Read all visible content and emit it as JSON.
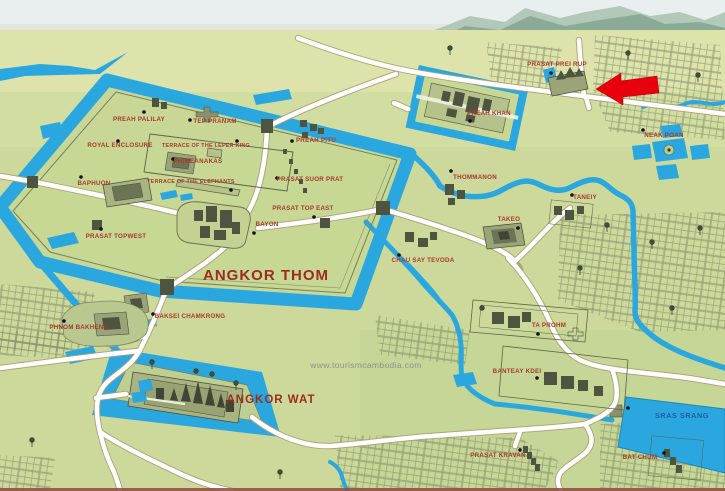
{
  "map": {
    "watermark": "www.tourismcambodia.com",
    "colors": {
      "water": "#2ba7e0",
      "land": "#ccd99b",
      "road": "#ffffff",
      "label_red": "#a8392c",
      "title_red": "#9c2c21",
      "water_label_blue": "#1d5e9e",
      "watermark_gray": "#8f9090",
      "arrow_red": "#e8000d",
      "sketch": "#4d5540"
    },
    "arrow": {
      "color": "#e8000d",
      "direction": "left",
      "points_at": "PRASAT PREI RUP"
    },
    "labels": [
      {
        "id": "prasat-prei-rup",
        "text": "PRASAT PREI RUP",
        "x": 557,
        "y": 66,
        "kind": "label",
        "dot": [
          551,
          73
        ]
      },
      {
        "id": "preah-khan",
        "text": "PREAH KHAN",
        "x": 489,
        "y": 115,
        "kind": "label",
        "dot": [
          470,
          121
        ]
      },
      {
        "id": "neak-poan",
        "text": "NEAK POAN",
        "x": 664,
        "y": 137,
        "kind": "label",
        "dot": [
          643,
          130
        ]
      },
      {
        "id": "preah-palilay",
        "text": "PREAH PALILAY",
        "x": 139,
        "y": 121,
        "kind": "label",
        "dot": [
          144,
          112
        ]
      },
      {
        "id": "tep-pranam",
        "text": "TEP PRANAM",
        "x": 215,
        "y": 123,
        "kind": "label",
        "dot": [
          190,
          120
        ]
      },
      {
        "id": "royal-enclosure",
        "text": "ROYAL ENCLOSURE",
        "x": 120,
        "y": 147,
        "kind": "label",
        "dot": [
          118,
          141
        ]
      },
      {
        "id": "terrace-of-the-leper-king",
        "text": "TERRACE OF THE LEPER KING",
        "x": 206,
        "y": 147,
        "kind": "small",
        "dot": [
          237,
          141
        ]
      },
      {
        "id": "phimeanakas",
        "text": "PHIMEANAKAS",
        "x": 198,
        "y": 163,
        "kind": "label",
        "dot": [
          173,
          159
        ]
      },
      {
        "id": "baphuon",
        "text": "BAPHUON",
        "x": 94,
        "y": 185,
        "kind": "label",
        "dot": [
          81,
          177
        ]
      },
      {
        "id": "terrace-of-the-elephants",
        "text": "TERRACE OF THE ELEPHANTS",
        "x": 191,
        "y": 183,
        "kind": "small",
        "dot": [
          231,
          190
        ]
      },
      {
        "id": "preah-pitu",
        "text": "PREAH PITU",
        "x": 316,
        "y": 142,
        "kind": "label",
        "dot": [
          292,
          141
        ]
      },
      {
        "id": "prasat-suor-prat",
        "text": "PRASAT SUOR PRAT",
        "x": 310,
        "y": 181,
        "kind": "label",
        "dot": [
          277,
          178
        ]
      },
      {
        "id": "prasat-top-east",
        "text": "PRASAT TOP EAST",
        "x": 303,
        "y": 210,
        "kind": "label",
        "dot": [
          314,
          217
        ]
      },
      {
        "id": "bayon",
        "text": "BAYON",
        "x": 267,
        "y": 226,
        "kind": "label",
        "dot": [
          254,
          233
        ]
      },
      {
        "id": "chau-say-tevoda",
        "text": "CHAU SAY TEVODA",
        "x": 423,
        "y": 262,
        "kind": "label",
        "dot": [
          399,
          255
        ]
      },
      {
        "id": "thommanon",
        "text": "THOMMANON",
        "x": 475,
        "y": 179,
        "kind": "label",
        "dot": [
          451,
          171
        ]
      },
      {
        "id": "taneiy",
        "text": "TANEIY",
        "x": 585,
        "y": 199,
        "kind": "label",
        "dot": [
          572,
          195
        ]
      },
      {
        "id": "takeo",
        "text": "TAKEO",
        "x": 509,
        "y": 221,
        "kind": "label",
        "dot": [
          518,
          228
        ]
      },
      {
        "id": "prasat-topwest",
        "text": "PRASAT TOPWEST",
        "x": 116,
        "y": 238,
        "kind": "label",
        "dot": [
          101,
          229
        ]
      },
      {
        "id": "phnom-bakheng",
        "text": "PHNOM BAKHENG",
        "x": 79,
        "y": 329,
        "kind": "label",
        "dot": [
          64,
          321
        ]
      },
      {
        "id": "baksei-chamkrong",
        "text": "BAKSEI CHAMKRONG",
        "x": 190,
        "y": 318,
        "kind": "label",
        "dot": [
          153,
          314
        ]
      },
      {
        "id": "ta-prohm",
        "text": "TA PROHM",
        "x": 549,
        "y": 327,
        "kind": "label",
        "dot": [
          538,
          334
        ]
      },
      {
        "id": "banteay-kdei",
        "text": "BANTEAY KDEI",
        "x": 517,
        "y": 373,
        "kind": "label",
        "dot": [
          537,
          378
        ]
      },
      {
        "id": "prasat-kravan",
        "text": "PRASAT KRAVAN",
        "x": 498,
        "y": 457,
        "kind": "label",
        "dot": [
          520,
          450
        ]
      },
      {
        "id": "bat-chum",
        "text": "BAT CHUM",
        "x": 640,
        "y": 459,
        "kind": "label",
        "dot": [
          664,
          453
        ]
      },
      {
        "id": "angkor-thom",
        "text": "ANGKOR THOM",
        "x": 266,
        "y": 280,
        "kind": "title",
        "size": 15
      },
      {
        "id": "angkor-wat",
        "text": "ANGKOR WAT",
        "x": 271,
        "y": 403,
        "kind": "title",
        "size": 11.5
      },
      {
        "id": "sras-srang",
        "text": "SRAS SRANG",
        "x": 682,
        "y": 418,
        "kind": "water",
        "dot": [
          628,
          408
        ]
      },
      {
        "id": "watermark",
        "text": "www.tourismcambodia.com",
        "x": 366,
        "y": 368,
        "kind": "watermark"
      }
    ]
  }
}
